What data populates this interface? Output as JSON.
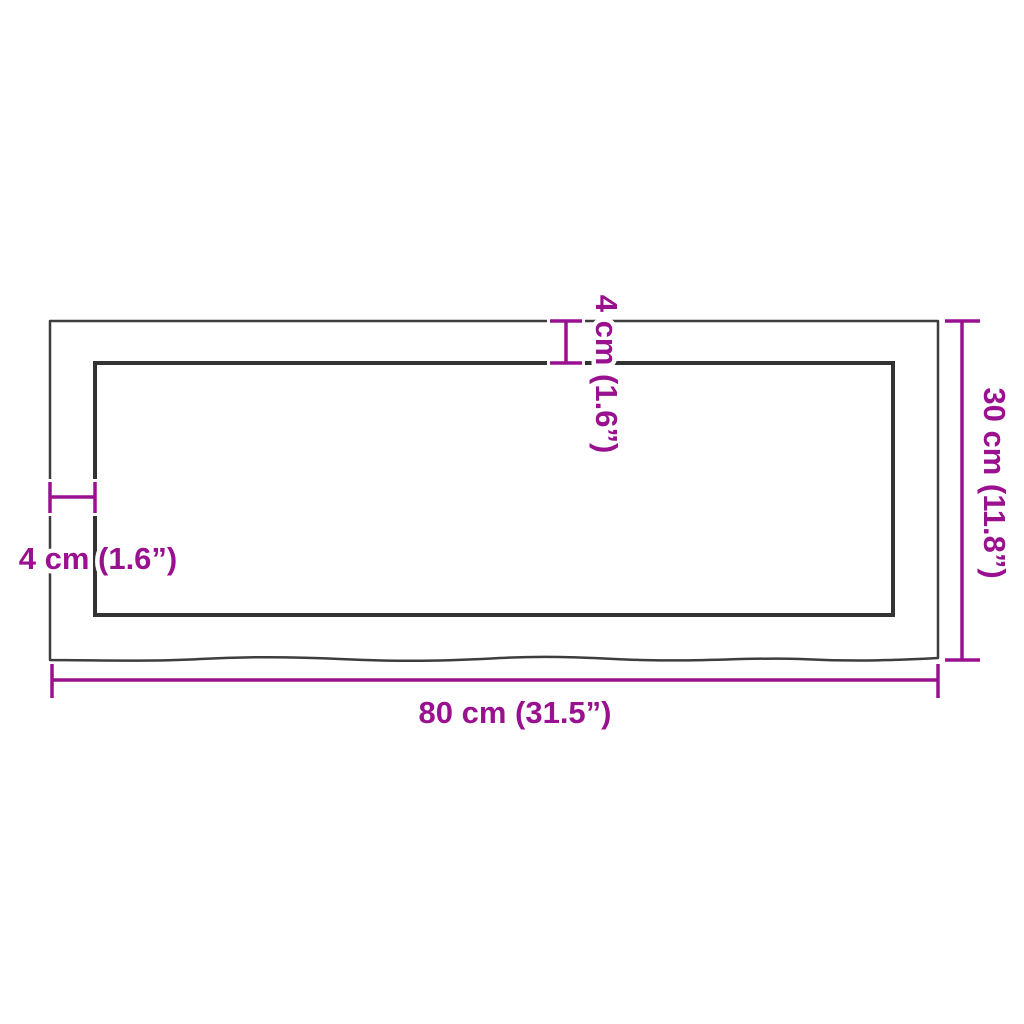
{
  "diagram": {
    "colors": {
      "dimension": "#9A1190",
      "outline_outer": "#3D3D3D",
      "outline_inner": "#333333",
      "background": "#FFFFFF"
    },
    "labels": {
      "width": "80 cm (31.5”)",
      "height": "30 cm (11.8”)",
      "thickness_top": "4 cm (1.6”)",
      "thickness_left": "4 cm (1.6”)"
    }
  }
}
